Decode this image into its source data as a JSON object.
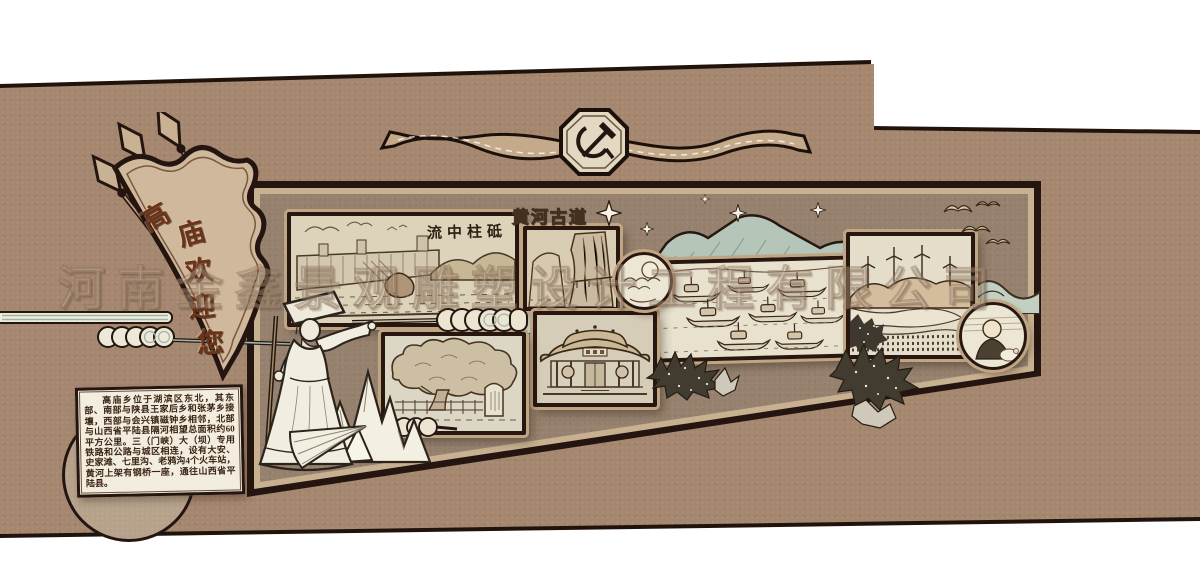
{
  "watermark": {
    "text": "河南金鑫景观雕塑设计工程有限公司"
  },
  "welcome_flag": {
    "full_text": "高庙欢迎您",
    "chars": [
      "高",
      "庙",
      "欢",
      "迎",
      "您"
    ]
  },
  "top_banner": {
    "emblem_icon": "hammer-sickle"
  },
  "panels": {
    "dam": {
      "caption": "流中柱砥",
      "subject": "Sanmenxia dam sketch"
    },
    "plank_road": {
      "caption": "黄河古道",
      "subject": "Yellow River cliff road sketch"
    },
    "boats": {
      "subject": "ancient boats on the river"
    },
    "temple": {
      "subject": "temple facade sketch"
    },
    "ancient_tree": {
      "subject": "ancient tree and stele sketch"
    },
    "wind_farm": {
      "subject": "wind turbines and terraced river bank"
    },
    "person_medallion": {
      "subject": "portrait sketch"
    },
    "sun_medallion": {
      "subject": "sun and clouds"
    }
  },
  "info_box": {
    "text": "高庙乡位于湖滨区东北，其东部、南部与陕县王家后乡和张茅乡接壤，西部与会兴镇磁钟乡相邻，北部与山西省平陆县隔河相望总面积约60平方公里。三（门峡）大（坝）专用铁路和公路与城区相连，设有大安、史家滩、七里沟、老鸦沟4个火车站，黄河上架有钢桥一座，通往山西省平陆县。"
  },
  "colors": {
    "wall": "#a5876f",
    "field": "#96816e",
    "frame": "#241510",
    "mat": "#c8b190",
    "panel_bg": "#e0d9c6",
    "teal_accent": "#b5c6b8",
    "flag_text": "#6b3318",
    "parchment": "#f2edde"
  }
}
